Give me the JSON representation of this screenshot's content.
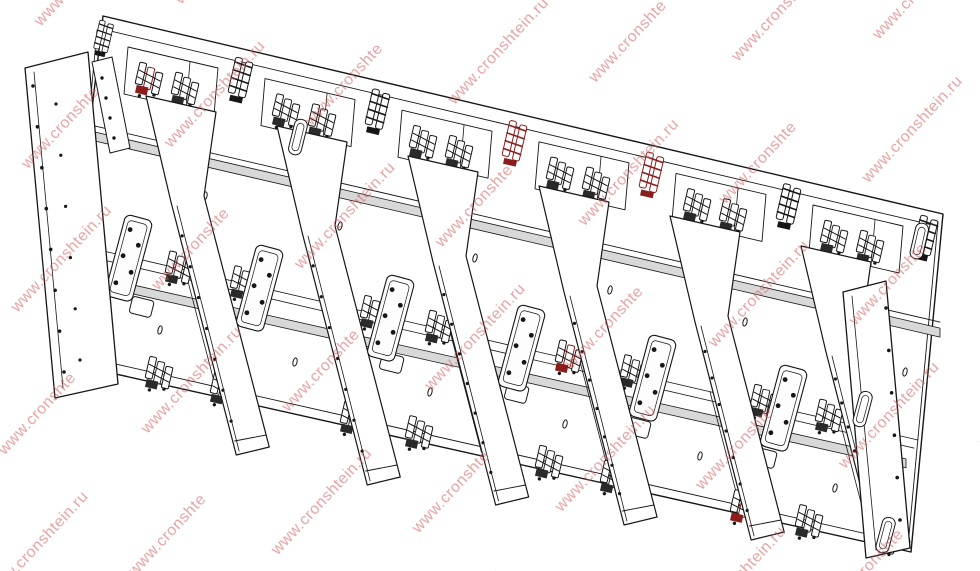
{
  "watermark": {
    "text": "www.cronshtein.ru",
    "color": "#cf5454",
    "opacity": 0.55,
    "angle_deg": -47,
    "font_size": 16
  },
  "drawing": {
    "background": "#ffffff",
    "line_color": "#161616",
    "rail_fill": "#d8d8d8",
    "accent_color": "#8b1d1d",
    "vertical_rails": 6,
    "panel_rows": 2,
    "window_cutouts": 6
  }
}
